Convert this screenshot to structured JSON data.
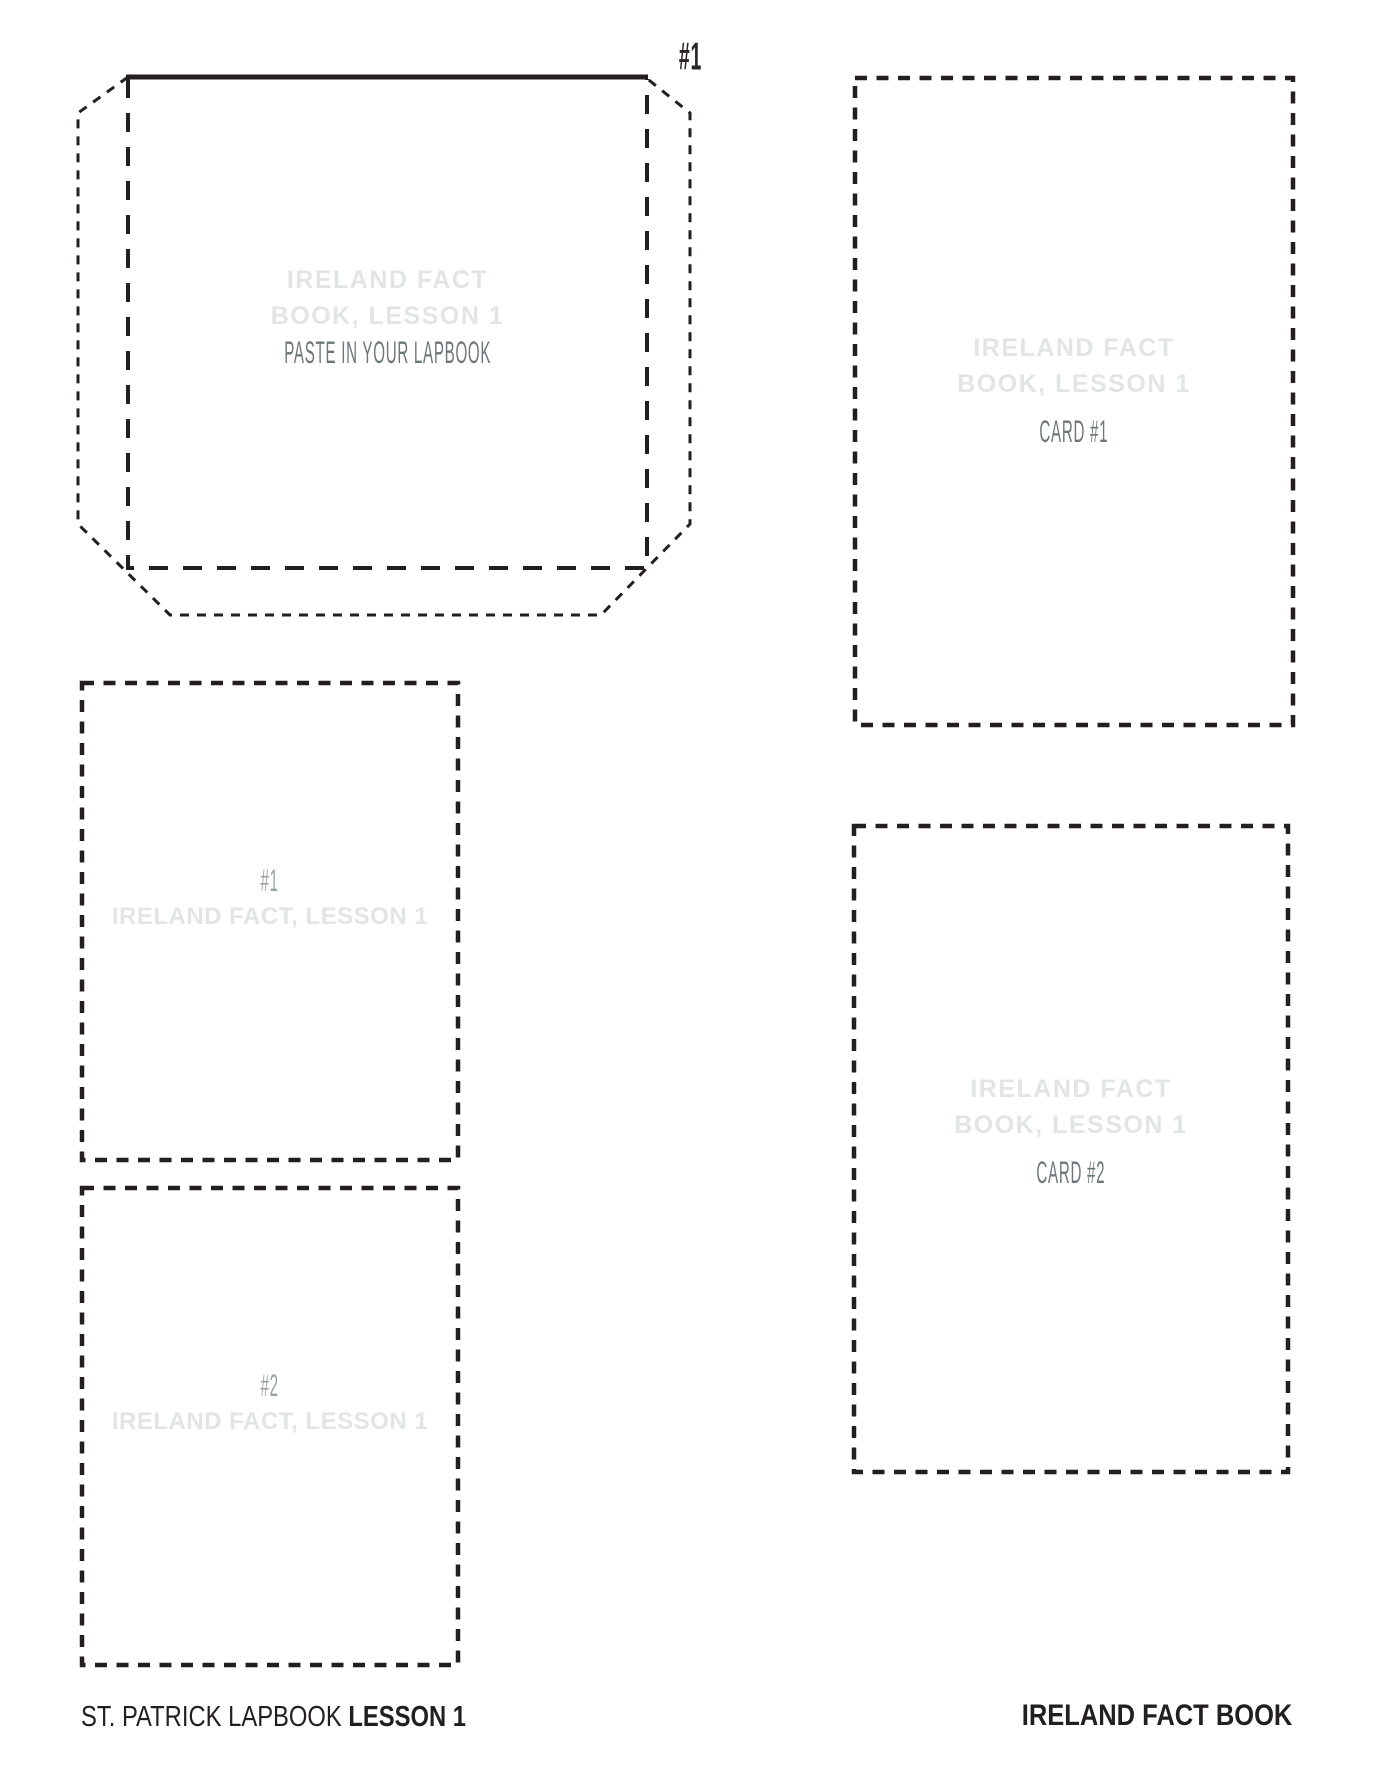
{
  "colors": {
    "ink": "#231f20",
    "watermark_text": "#e2e5e6",
    "muted_text": "#6d7678",
    "gray_label": "#9aa1a4"
  },
  "envelope": {
    "number_label": "#1",
    "title_line1": "IRELAND FACT",
    "title_line2": "BOOK, LESSON 1",
    "instruction": "PASTE IN YOUR LAPBOOK"
  },
  "card1": {
    "title_line1": "IRELAND FACT",
    "title_line2": "BOOK, LESSON 1",
    "label": "CARD #1"
  },
  "card2": {
    "title_line1": "IRELAND FACT",
    "title_line2": "BOOK, LESSON 1",
    "label": "CARD #2"
  },
  "slip1": {
    "number": "#1",
    "title": "IRELAND FACT, LESSON 1"
  },
  "slip2": {
    "number": "#2",
    "title": "IRELAND FACT, LESSON 1"
  },
  "footer": {
    "left_regular": "ST. PATRICK LAPBOOK ",
    "left_bold": "LESSON 1",
    "right": "IRELAND FACT BOOK"
  }
}
